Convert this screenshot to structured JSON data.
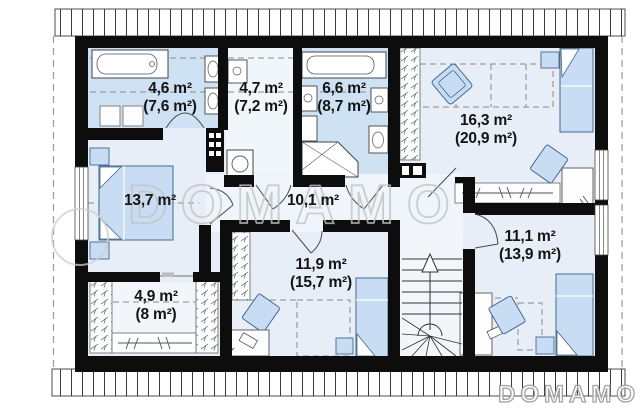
{
  "watermark": {
    "large": "DOMAMO",
    "small": "DOMAMO"
  },
  "rooms": [
    {
      "id": "bathroom-top-left",
      "label_main": "4,6 m²",
      "label_sub": "(7,6 m²)"
    },
    {
      "id": "laundry-room",
      "label_main": "4,7 m²",
      "label_sub": "(7,2 m²)"
    },
    {
      "id": "bathroom-top-mid",
      "label_main": "6,6 m²",
      "label_sub": "(8,7 m²)"
    },
    {
      "id": "bedroom-top-right",
      "label_main": "16,3 m²",
      "label_sub": "(20,9 m²)"
    },
    {
      "id": "bedroom-left",
      "label_main": "13,7 m²",
      "label_sub": ""
    },
    {
      "id": "hallway",
      "label_main": "10,1 m²",
      "label_sub": ""
    },
    {
      "id": "bedroom-right",
      "label_main": "11,1 m²",
      "label_sub": "(13,9 m²)"
    },
    {
      "id": "wardrobe-room",
      "label_main": "4,9 m²",
      "label_sub": "(8 m²)"
    },
    {
      "id": "bedroom-bottom",
      "label_main": "11,9 m²",
      "label_sub": "(15,7 m²)"
    }
  ],
  "colors": {
    "wall": "#0d0d0d",
    "floor_base": "#e7eef7",
    "floor_bath": "#cfe2f4",
    "furniture": "#c8ddf3",
    "watermark": "#c3c3c3"
  }
}
